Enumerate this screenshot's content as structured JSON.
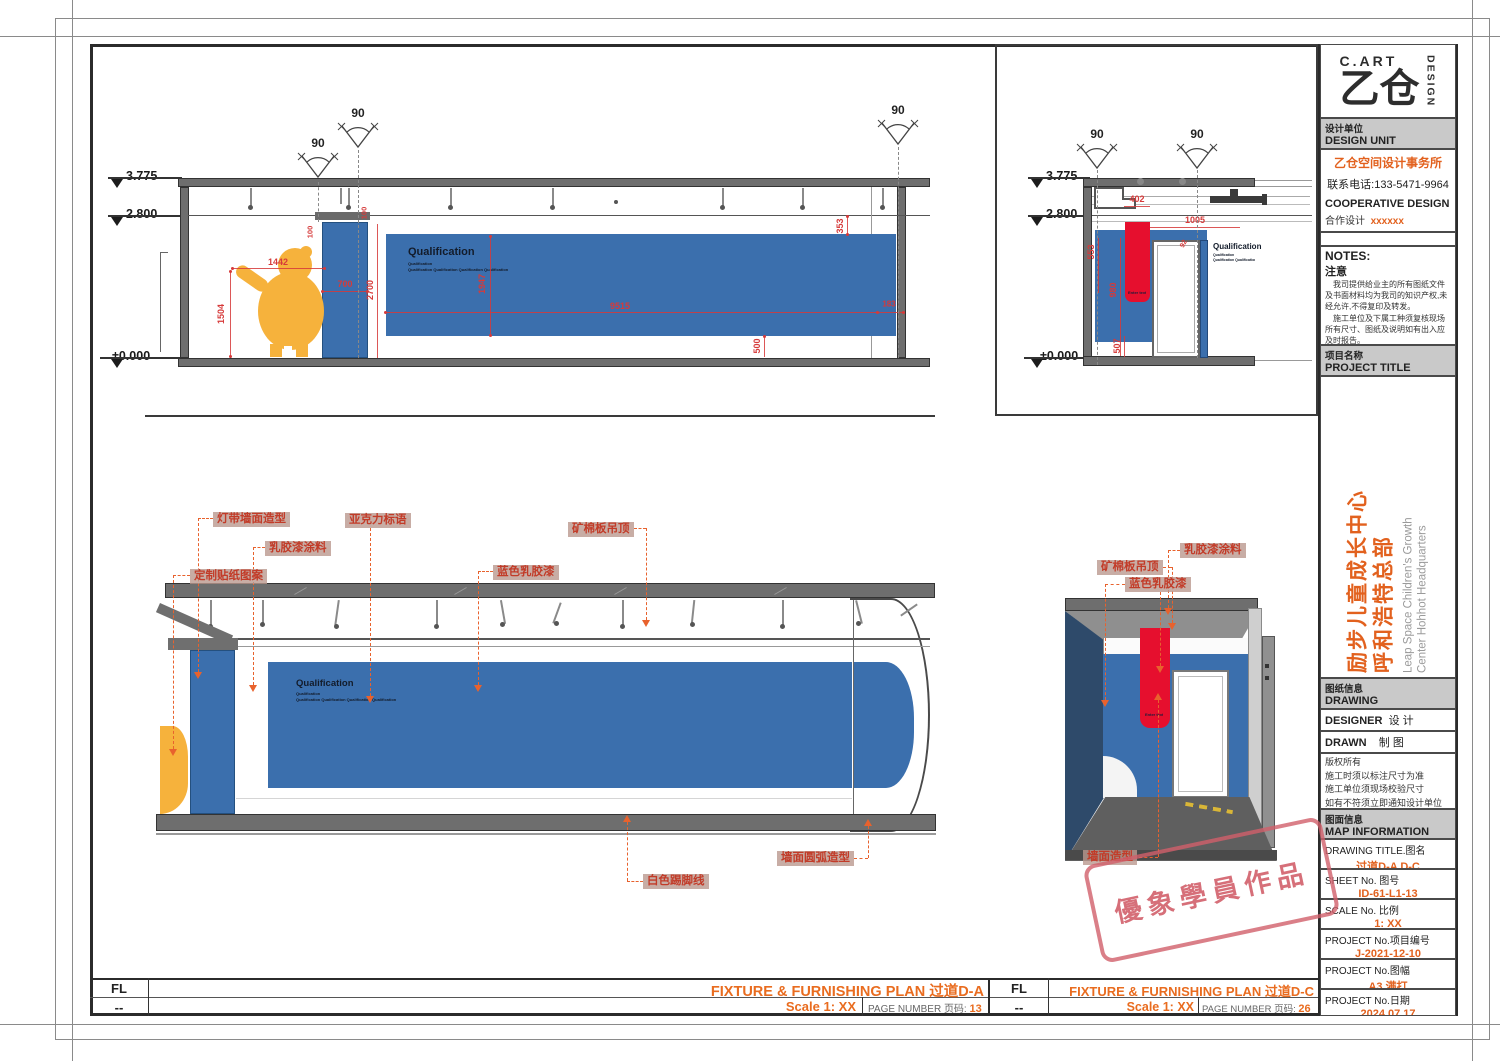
{
  "sheet": {
    "footer_da": {
      "fl": "FL",
      "dash": "--",
      "title": "FIXTURE & FURNISHING PLAN 过道D-A",
      "scale": "Scale 1: XX",
      "page_label": "PAGE NUMBER 页码:",
      "page": "13"
    },
    "footer_dc": {
      "fl": "FL",
      "dash": "--",
      "title": "FIXTURE & FURNISHING PLAN 过道D-C",
      "scale": "Scale 1: XX",
      "page_label": "PAGE NUMBER 页码:",
      "page": "26"
    }
  },
  "title_block": {
    "logo": {
      "cart": "C.ART",
      "glyph": "乙仓",
      "design": "DESIGN"
    },
    "design_unit": {
      "cn": "设计单位",
      "en": "DESIGN UNIT",
      "firm": "乙仓空间设计事务所",
      "phone": "联系电话:133-5471-9964",
      "coop_en": "COOPERATIVE DESIGN",
      "coop_cn": "合作设计",
      "coop_val": "xxxxxx"
    },
    "notes": {
      "en": "NOTES:",
      "cn": "注意",
      "p1": "我司提供给业主的所有图纸文件及书面材料均为我司的知识产权,未经允许,不得复印及转发。",
      "p2": "施工单位及下属工种须复核现场所有尺寸、图纸及说明如有出入应及时报告。"
    },
    "project_title": {
      "cn": "项目名称",
      "en": "PROJECT TITLE",
      "cn1": "励步儿童成长中心",
      "cn2": "呼和浩特总部",
      "en1": "Leap Space Children's Growth",
      "en2": "Center Hohhot Headquarters"
    },
    "drawing_info": {
      "cn": "图纸信息",
      "en": "DRAWING INFORMATION",
      "designer": "DESIGNER",
      "designer_cn": "设 计",
      "drawn": "DRAWN",
      "drawn_cn": "制 图",
      "c1": "版权所有",
      "c2": "施工时须以标注尺寸为准",
      "c3": "施工单位须现场校验尺寸",
      "c4": "如有不符须立即通知设计单位"
    },
    "map_info": {
      "cn": "图面信息",
      "en": "MAP INFORMATION",
      "dt_label": "DRAWING TITLE.图名",
      "dt_val": "过道D-A D-C",
      "sheet_label": "SHEET No. 图号",
      "sheet_val": "ID-61-L1-13",
      "scale_label": "SCALE No. 比例",
      "scale_val": "1: XX",
      "pno_label": "PROJECT No.项目编号",
      "pno_val": "J-2021-12-10",
      "fmt_label": "PROJECT No.图幅",
      "fmt_val": "A3 满打",
      "date_label": "PROJECT No.日期",
      "date_val": "2024.07.17"
    }
  },
  "views": {
    "elev_da": {
      "angle": "90",
      "levels": [
        "3.775",
        "2.800",
        "±0.000"
      ],
      "sign": {
        "title": "Qualification",
        "sub1": "Qualification",
        "sub2": "Qualification Qualification Qualification Qualification"
      },
      "dims": {
        "w1442": "1442",
        "h1504": "1504",
        "w700": "700",
        "h2700": "2700",
        "t100a": "100",
        "t100b": "100",
        "h1947": "1947",
        "w9515": "9515",
        "h353": "353",
        "h500": "500",
        "w183": "183"
      }
    },
    "elev_dc": {
      "angle": "90",
      "levels": [
        "3.775",
        "2.800",
        "±0.000"
      ],
      "sign": {
        "title": "Qualification",
        "sub1": "Qualification",
        "sub2": "Qualification Qualification"
      },
      "enter": "Enter text",
      "dims": {
        "w402": "402",
        "w1005": "1005",
        "h553": "553",
        "h980": "980",
        "h507": "507",
        "d92": "92"
      }
    },
    "persp_da": {
      "labels": [
        "灯带墙面造型",
        "亚克力标语",
        "乳胶漆涂料",
        "定制贴纸图案",
        "蓝色乳胶漆",
        "矿棉板吊顶",
        "白色踢脚线",
        "墙面圆弧造型"
      ],
      "sign": {
        "title": "Qualification",
        "sub1": "Qualification",
        "sub2": "Qualification Qualification Qualification Qualification"
      }
    },
    "persp_dc": {
      "labels": [
        "乳胶漆涂料",
        "矿棉板吊顶",
        "蓝色乳胶漆",
        "墙面造型"
      ],
      "enter": "Enter text"
    }
  },
  "stamp": {
    "text": "優象學員作品"
  },
  "colors": {
    "accent_orange": "#E2611E",
    "dim_red": "#D63A3A",
    "panel_blue": "#3B6FAD",
    "sign_red": "#E60F2E",
    "bear_yellow": "#F6B23C",
    "stamp_pink": "#D4707C"
  }
}
